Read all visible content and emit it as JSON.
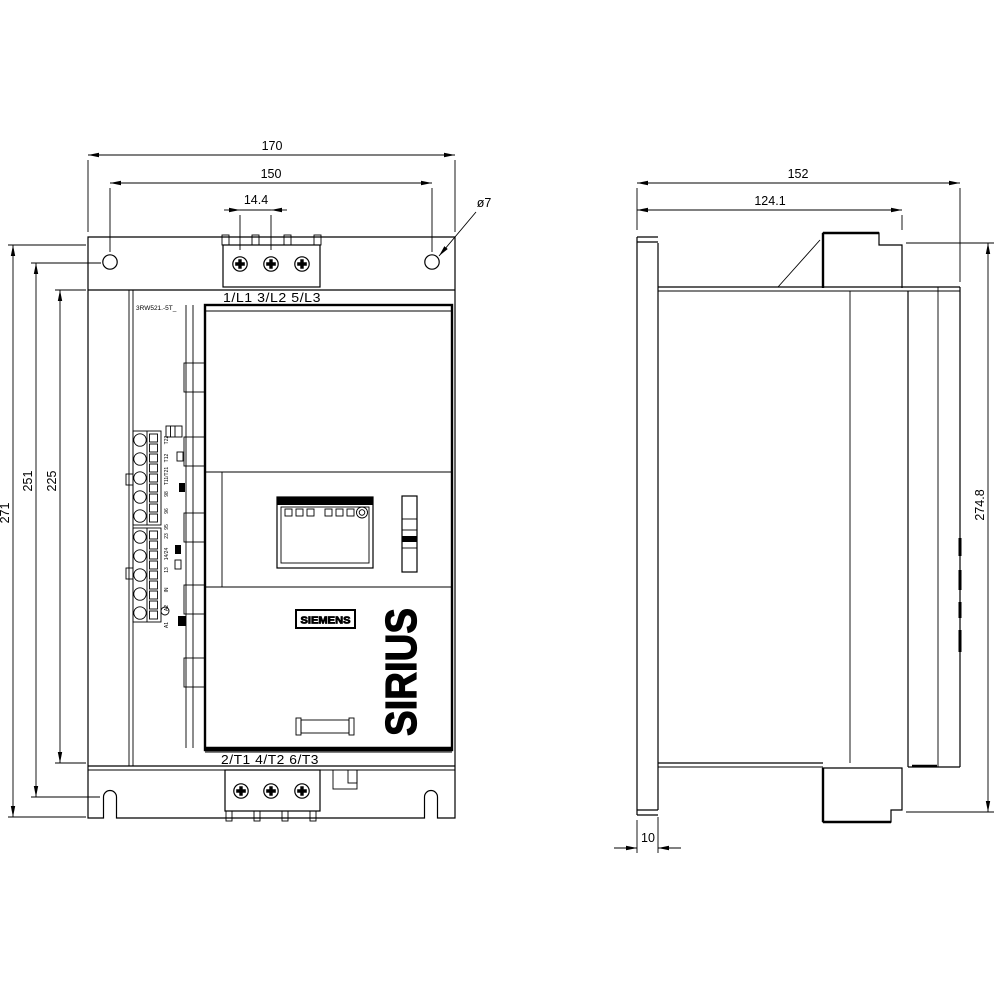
{
  "front_view": {
    "dims": {
      "width_outer": "170",
      "width_holes": "150",
      "screw_pitch": "14.4",
      "hole_dia": "ø7",
      "height_outer": "271",
      "height_holes": "251",
      "height_body": "225"
    },
    "terminals": {
      "top": "1/L1 3/L2 5/L3",
      "bottom": "2/T1 4/T2 6/T3"
    },
    "product_code": "3RW521.-5T_",
    "brand": "SIEMENS",
    "series": "SIRIUS",
    "control_terminals": {
      "upper": [
        "T22",
        "T12",
        "T11/T21",
        "98",
        "96",
        "95"
      ],
      "lower": [
        "23",
        "14/24",
        "13",
        "IN",
        "A2",
        "A1"
      ]
    }
  },
  "side_view": {
    "dims": {
      "depth_outer": "152",
      "depth_front": "124.1",
      "height_total": "274.8",
      "plate_thickness": "10"
    }
  }
}
